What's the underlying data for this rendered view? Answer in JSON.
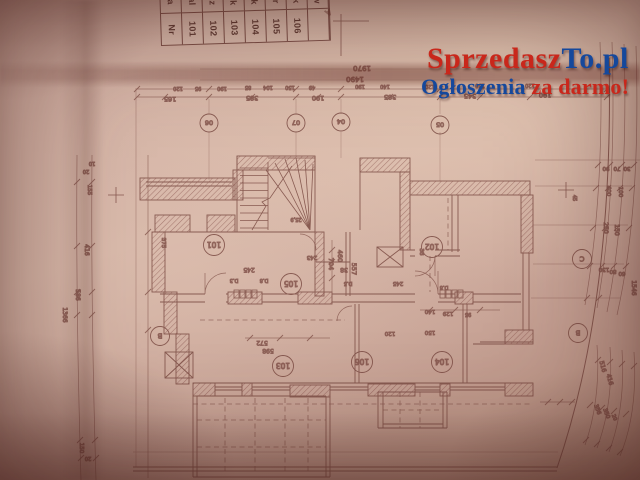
{
  "watermark": {
    "site_first": "Sprzedasz",
    "site_second": "To.pl",
    "tagline_first": "Ogłoszenia",
    "tagline_second": "za darmo!",
    "red_color": "#c9271b",
    "blue_color": "#15489c"
  },
  "legend_table": {
    "columns": [
      {
        "top": "Na",
        "bottom": "Nr"
      },
      {
        "top": "Hal",
        "bottom": "101"
      },
      {
        "top": "Łaz",
        "bottom": "102"
      },
      {
        "top": "Pok",
        "bottom": "103"
      },
      {
        "top": "Pok",
        "bottom": "104"
      },
      {
        "top": "Gar",
        "bottom": "105"
      },
      {
        "top": "Pok",
        "bottom": "106"
      },
      {
        "top": "Pow",
        "bottom": ""
      }
    ]
  },
  "plan": {
    "ink_color": "#7a4a42",
    "paper_color": "#d2b2a6",
    "axis_circles": [
      {
        "x": 209,
        "y": 123,
        "t": "06"
      },
      {
        "x": 296,
        "y": 123,
        "t": "07"
      },
      {
        "x": 341,
        "y": 122,
        "t": "04"
      },
      {
        "x": 440,
        "y": 125,
        "t": "05"
      }
    ],
    "letter_circles": [
      {
        "x": 160,
        "y": 336,
        "t": "B"
      },
      {
        "x": 582,
        "y": 259,
        "t": "C"
      },
      {
        "x": 578,
        "y": 333,
        "t": "B"
      }
    ],
    "room_circles": [
      {
        "x": 214,
        "y": 245,
        "t": "101"
      },
      {
        "x": 432,
        "y": 247,
        "t": "102"
      },
      {
        "x": 291,
        "y": 284,
        "t": "105"
      },
      {
        "x": 283,
        "y": 366,
        "t": "103"
      },
      {
        "x": 362,
        "y": 362,
        "t": "106"
      },
      {
        "x": 442,
        "y": 362,
        "t": "104"
      }
    ],
    "dim_labels": [
      {
        "x": 362,
        "y": 66,
        "t": "1970",
        "s": 7
      },
      {
        "x": 355,
        "y": 77,
        "t": "1490",
        "s": 7
      },
      {
        "x": 178,
        "y": 87,
        "t": "120",
        "s": 5
      },
      {
        "x": 198,
        "y": 87,
        "t": "95",
        "s": 5
      },
      {
        "x": 222,
        "y": 87,
        "t": "190",
        "s": 5
      },
      {
        "x": 248,
        "y": 86,
        "t": "85",
        "s": 5
      },
      {
        "x": 268,
        "y": 86,
        "t": "104",
        "s": 5
      },
      {
        "x": 290,
        "y": 86,
        "t": "150",
        "s": 5
      },
      {
        "x": 312,
        "y": 86,
        "t": "49",
        "s": 5
      },
      {
        "x": 360,
        "y": 85,
        "t": "190",
        "s": 5
      },
      {
        "x": 385,
        "y": 85,
        "t": "140",
        "s": 5
      },
      {
        "x": 430,
        "y": 85,
        "t": "120",
        "s": 5
      },
      {
        "x": 480,
        "y": 84,
        "t": "150",
        "s": 5
      },
      {
        "x": 530,
        "y": 84,
        "t": "120",
        "s": 5
      },
      {
        "x": 170,
        "y": 97,
        "t": "165",
        "s": 6.5
      },
      {
        "x": 252,
        "y": 96,
        "t": "385",
        "s": 6.5
      },
      {
        "x": 318,
        "y": 96,
        "t": "190",
        "s": 6.5
      },
      {
        "x": 390,
        "y": 95,
        "t": "385",
        "s": 6.5
      },
      {
        "x": 470,
        "y": 94,
        "t": "345",
        "s": 6.5
      },
      {
        "x": 545,
        "y": 93,
        "t": "190",
        "s": 6.5
      },
      {
        "x": 329,
        "y": 264,
        "t": "704",
        "s": 6.5,
        "r": 90
      },
      {
        "x": 338,
        "y": 256,
        "t": "460",
        "s": 6.5,
        "r": 90
      },
      {
        "x": 352,
        "y": 269,
        "t": "557",
        "s": 6.5,
        "r": 90
      },
      {
        "x": 249,
        "y": 268,
        "t": "245"
      },
      {
        "x": 312,
        "y": 256,
        "t": "243",
        "s": 5.5
      },
      {
        "x": 344,
        "y": 268,
        "t": "38"
      },
      {
        "x": 398,
        "y": 282,
        "t": "245",
        "s": 5.5
      },
      {
        "x": 420,
        "y": 252,
        "t": "38",
        "s": 5.5,
        "r": 90
      },
      {
        "x": 262,
        "y": 341,
        "t": "572"
      },
      {
        "x": 268,
        "y": 349,
        "t": "598"
      },
      {
        "x": 430,
        "y": 310,
        "t": "140",
        "s": 5.5
      },
      {
        "x": 448,
        "y": 312,
        "t": "129",
        "s": 5.5
      },
      {
        "x": 468,
        "y": 313,
        "t": "95",
        "s": 5
      },
      {
        "x": 390,
        "y": 332,
        "t": "120",
        "s": 5.5
      },
      {
        "x": 430,
        "y": 331,
        "t": "150",
        "s": 5.5
      },
      {
        "x": 162,
        "y": 243,
        "t": "375",
        "s": 5.5,
        "r": 90
      },
      {
        "x": 296,
        "y": 218,
        "t": "25,9",
        "s": 5
      },
      {
        "x": 234,
        "y": 279,
        "t": "D.3",
        "s": 5
      },
      {
        "x": 264,
        "y": 279,
        "t": "D.8",
        "s": 5
      },
      {
        "x": 444,
        "y": 286,
        "t": "D.8",
        "s": 5
      },
      {
        "x": 348,
        "y": 282,
        "t": "D.5",
        "s": 5
      },
      {
        "x": 606,
        "y": 167,
        "t": "90",
        "s": 5.5
      },
      {
        "x": 617,
        "y": 167,
        "t": "70",
        "s": 5.5
      },
      {
        "x": 627,
        "y": 167,
        "t": "30",
        "s": 5.5
      },
      {
        "x": 607,
        "y": 191,
        "t": "400",
        "s": 5.5,
        "r": 90
      },
      {
        "x": 619,
        "y": 192,
        "t": "100",
        "s": 5.5,
        "r": 90
      },
      {
        "x": 604,
        "y": 228,
        "t": "250",
        "s": 6,
        "r": 90
      },
      {
        "x": 615,
        "y": 230,
        "t": "150",
        "s": 6,
        "r": 90
      },
      {
        "x": 604,
        "y": 268,
        "t": "130",
        "s": 5.5
      },
      {
        "x": 613,
        "y": 270,
        "t": "80",
        "s": 5.5
      },
      {
        "x": 622,
        "y": 272,
        "t": "60",
        "s": 5.5
      },
      {
        "x": 632,
        "y": 288,
        "t": "1546",
        "s": 6,
        "r": 90
      },
      {
        "x": 601,
        "y": 367,
        "t": "516",
        "s": 6,
        "r": 75
      },
      {
        "x": 608,
        "y": 380,
        "t": "416",
        "s": 6,
        "r": 75
      },
      {
        "x": 596,
        "y": 410,
        "t": "356",
        "s": 5.5,
        "r": 70
      },
      {
        "x": 605,
        "y": 414,
        "t": "350",
        "s": 5.5,
        "r": 70
      },
      {
        "x": 613,
        "y": 418,
        "t": "20",
        "s": 5,
        "r": 70
      },
      {
        "x": 92,
        "y": 162,
        "t": "10",
        "s": 5
      },
      {
        "x": 86,
        "y": 170,
        "t": "20",
        "s": 5
      },
      {
        "x": 88,
        "y": 190,
        "t": "155",
        "s": 5.5,
        "r": 90
      },
      {
        "x": 85,
        "y": 250,
        "t": "416",
        "s": 6,
        "r": 90
      },
      {
        "x": 76,
        "y": 295,
        "t": "586",
        "s": 6,
        "r": 90
      },
      {
        "x": 63,
        "y": 315,
        "t": "1366",
        "s": 6,
        "r": 90
      },
      {
        "x": 80,
        "y": 448,
        "t": "150",
        "s": 5.5,
        "r": 90
      },
      {
        "x": 88,
        "y": 457,
        "t": "20",
        "s": 5
      },
      {
        "x": 327,
        "y": 10,
        "t": "A",
        "s": 8,
        "r": 150
      },
      {
        "x": 573,
        "y": 198,
        "t": "45",
        "s": 5,
        "r": 90
      }
    ]
  }
}
